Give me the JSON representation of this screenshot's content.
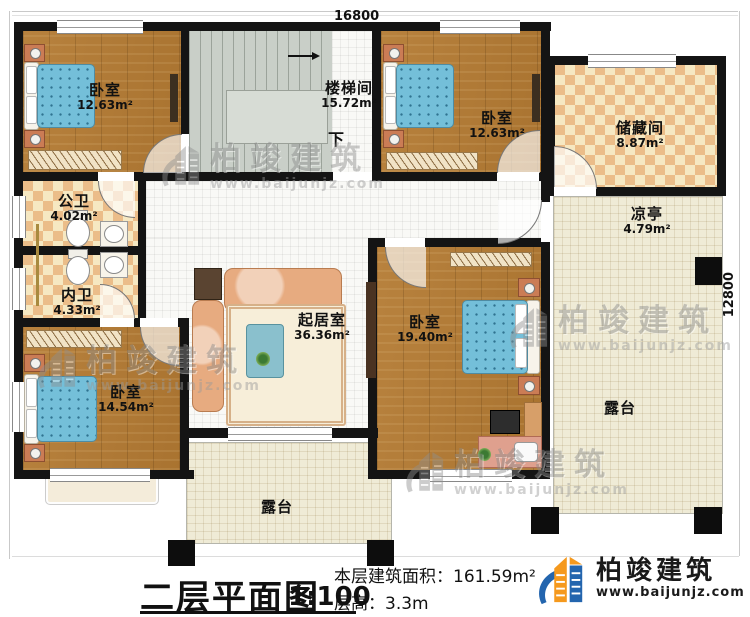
{
  "title_block": {
    "plan_title": "二层平面图",
    "scale": "1:100",
    "area_line": "本层建筑面积：161.59m²",
    "height_line": "层高：3.3m"
  },
  "dimensions": {
    "top": "16800",
    "right": "12800"
  },
  "stair": {
    "down": "下"
  },
  "rooms": {
    "bedroom_tl": {
      "name": "卧室",
      "area": "12.63m²"
    },
    "stairwell": {
      "name": "楼梯间",
      "area": "15.72m²"
    },
    "bedroom_tr": {
      "name": "卧室",
      "area": "12.63m²"
    },
    "storage": {
      "name": "储藏间",
      "area": "8.87m²"
    },
    "pavilion": {
      "name": "凉亭",
      "area": "4.79m²"
    },
    "public_bath": {
      "name": "公卫",
      "area": "4.02m²"
    },
    "private_bath": {
      "name": "内卫",
      "area": "4.33m²"
    },
    "living": {
      "name": "起居室",
      "area": "36.36m²"
    },
    "bedroom_master": {
      "name": "卧室",
      "area": "19.40m²"
    },
    "bedroom_bl": {
      "name": "卧室",
      "area": "14.54m²"
    },
    "terrace_bottom": {
      "name": "露台"
    },
    "terrace_right": {
      "name": "露台"
    }
  },
  "branding": {
    "company": "柏竣建筑",
    "website": "www.baijunjz.com"
  },
  "watermark": {
    "company": "柏竣建筑",
    "website": "www.baijunjz.com"
  },
  "icons": {
    "logo": "baijun-building-logo",
    "stair_direction": "down-arrow"
  },
  "colors": {
    "wall": "#141414",
    "wood_floor": "#b2803c",
    "tile_light": "#f6e8c2",
    "tile_dark": "#ebbd89",
    "terrace": "#efebd6",
    "stair": "#c9cfc8",
    "blanket_blue": "#74bfd9",
    "logo_blue": "#2365ae",
    "logo_orange": "#f5991d"
  }
}
